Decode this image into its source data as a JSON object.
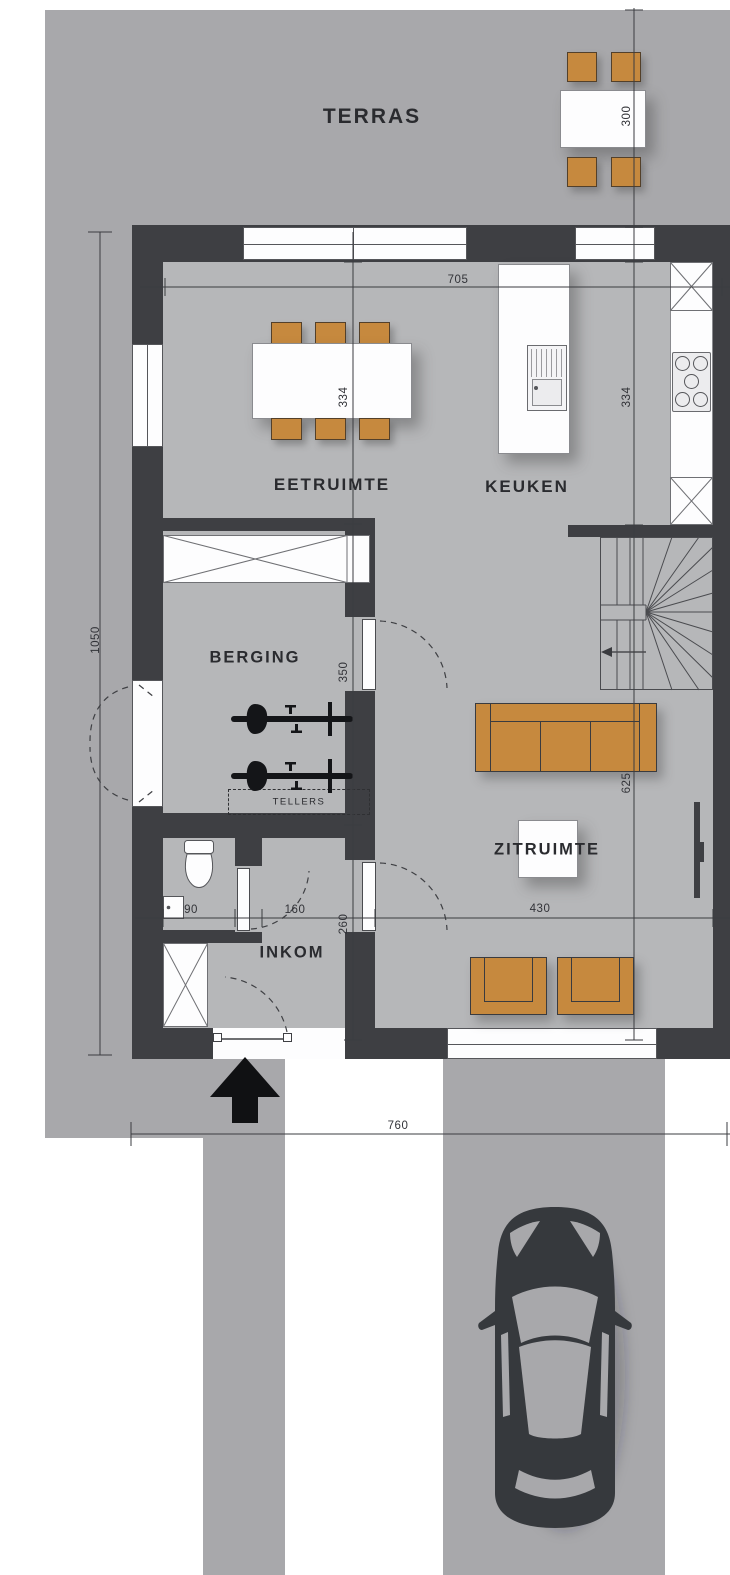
{
  "plan_title": "ground-floor-plan",
  "colors": {
    "outdoor_gray": "#a8a8ab",
    "floor_gray": "#b6b7b9",
    "wall_dark": "#3e3f43",
    "furniture_orange": "#c6893e",
    "line_dark": "#3c3d41",
    "car_dark": "#36393d"
  },
  "rooms": {
    "terras": {
      "label": "TERRAS"
    },
    "eetruimte": {
      "label": "EETRUIMTE"
    },
    "keuken": {
      "label": "KEUKEN"
    },
    "berging": {
      "label": "BERGING"
    },
    "inkom": {
      "label": "INKOM"
    },
    "zitruimte": {
      "label": "ZITRUIMTE"
    },
    "tellers": {
      "label": "TELLERS"
    }
  },
  "dimensions": {
    "terras_table_depth": "300",
    "plan_width_top": "705",
    "eetruimte_depth": "334",
    "keuken_depth": "334",
    "berging_depth": "350",
    "inkom_depth": "260",
    "zitruimte_depth": "625",
    "wc_width": "90",
    "inkom_width": "160",
    "zitruimte_width": "430",
    "building_depth": "1050",
    "plot_width": "760"
  }
}
